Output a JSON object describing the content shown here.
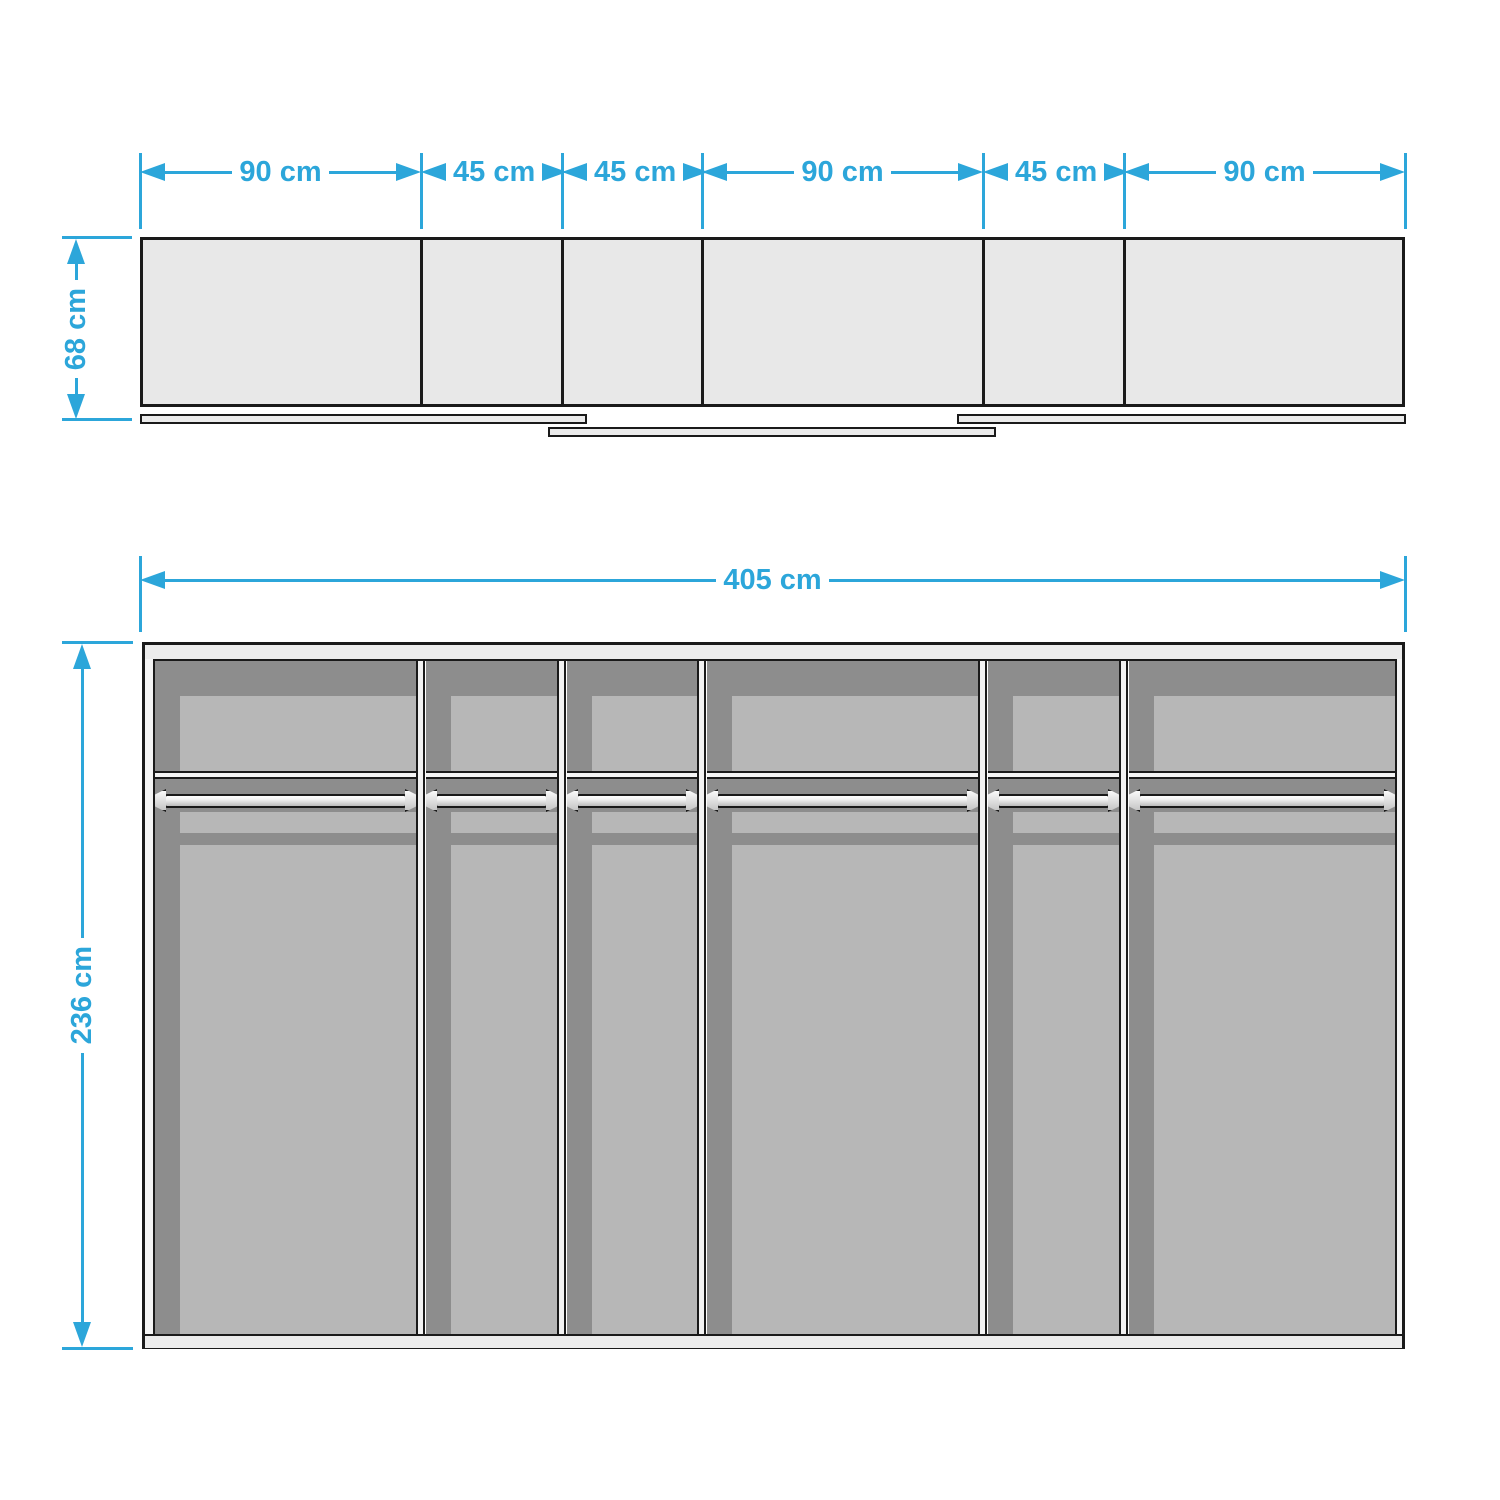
{
  "colors": {
    "accent": "#2CA6DA",
    "outline": "#1a1a1a",
    "cabinet_fill": "#e8e8e8",
    "interior_dark": "#8d8d8d",
    "interior_light": "#b7b7b7"
  },
  "top_view": {
    "segments": [
      {
        "label": "90 cm",
        "width_cm": 90
      },
      {
        "label": "45 cm",
        "width_cm": 45
      },
      {
        "label": "45 cm",
        "width_cm": 45
      },
      {
        "label": "90 cm",
        "width_cm": 90
      },
      {
        "label": "45 cm",
        "width_cm": 45
      },
      {
        "label": "90 cm",
        "width_cm": 90
      }
    ],
    "depth": {
      "label": "68 cm",
      "value_cm": 68
    },
    "sliding_rails": 3
  },
  "front_view": {
    "width": {
      "label": "405 cm",
      "value_cm": 405
    },
    "height": {
      "label": "236 cm",
      "value_cm": 236
    },
    "compartment_count": 6,
    "features": [
      "top shelf",
      "hanging rail"
    ]
  }
}
